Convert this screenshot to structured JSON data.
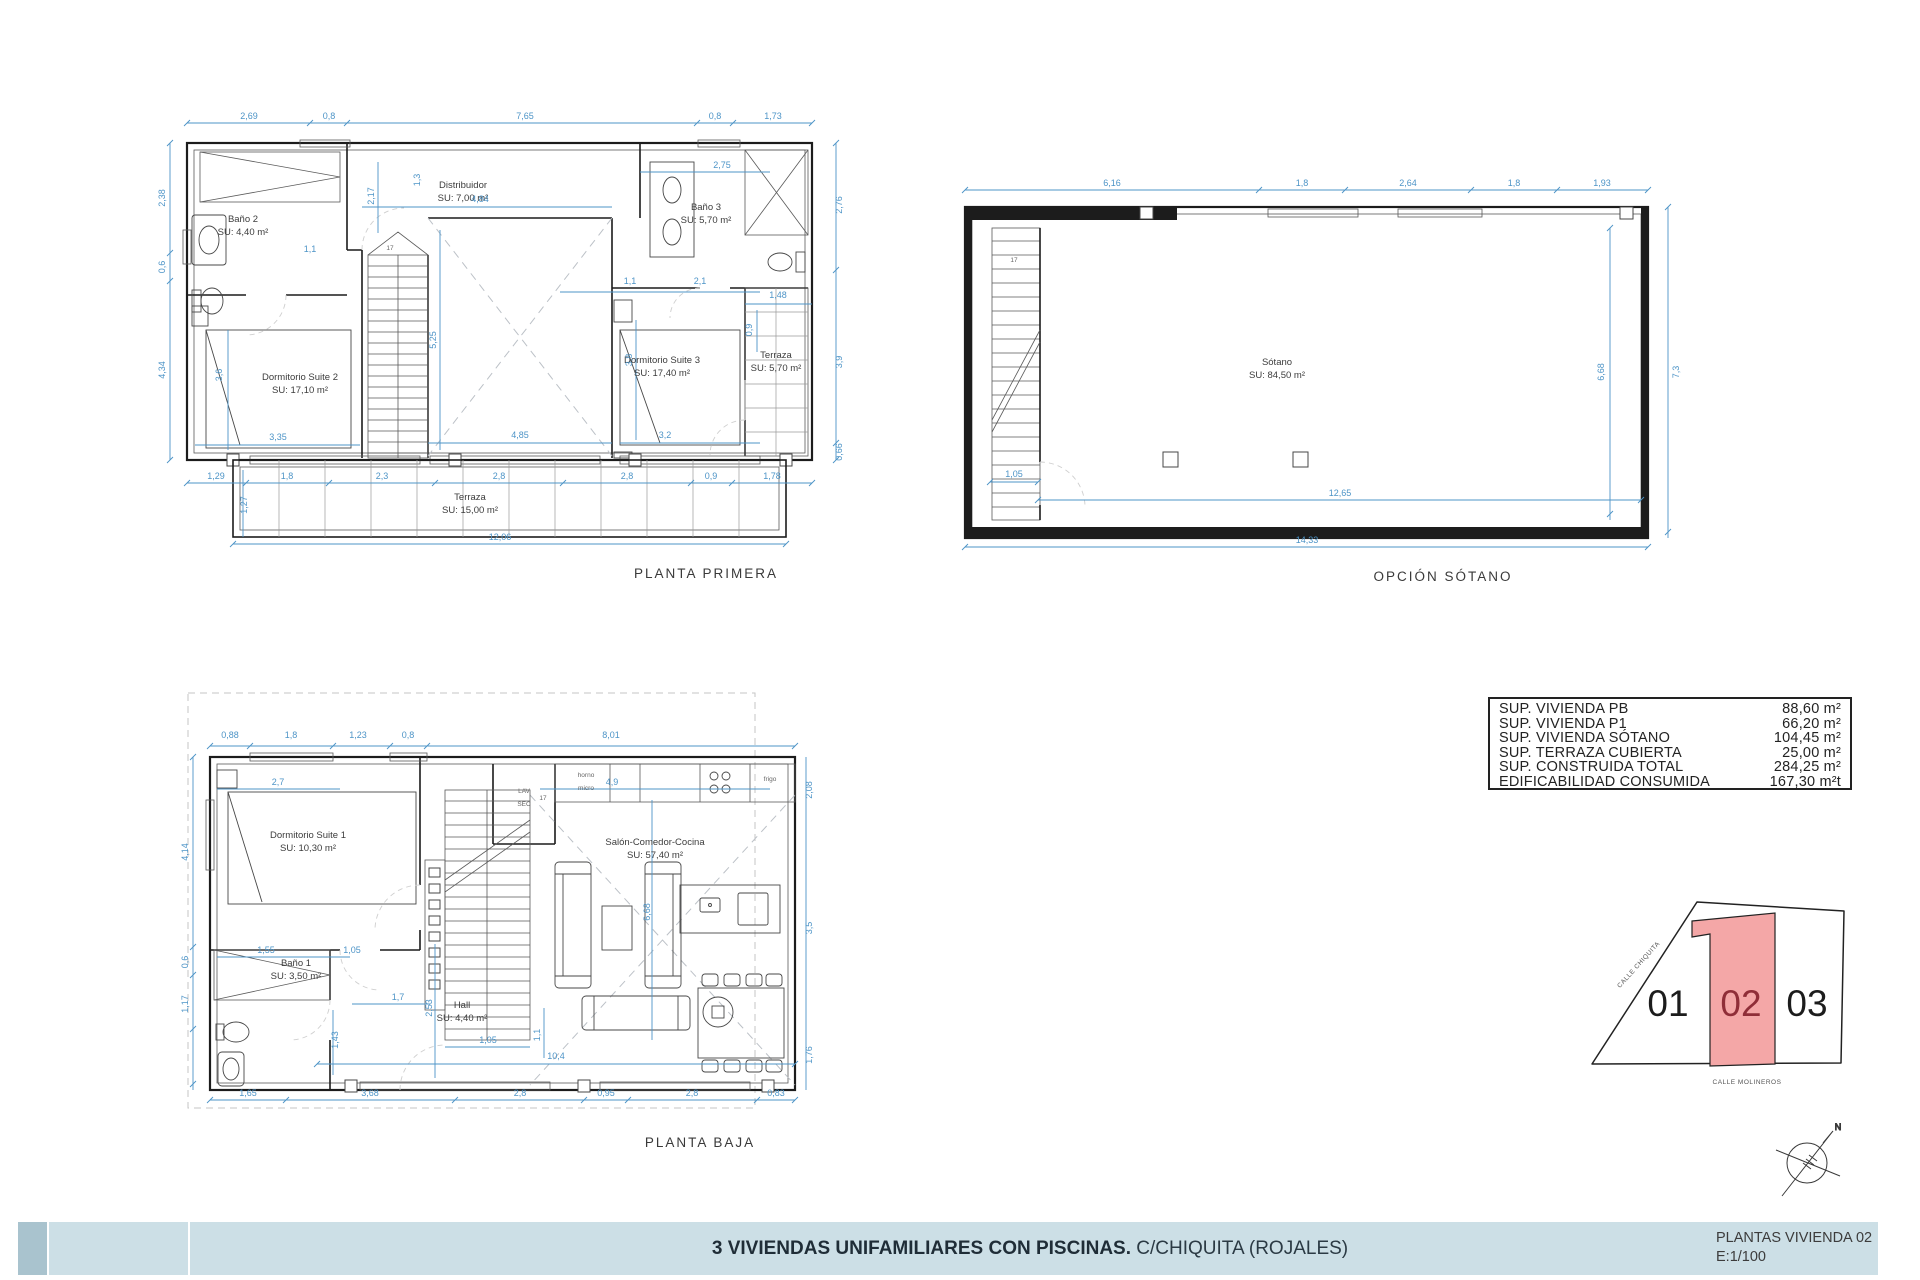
{
  "title_block": {
    "project_bold": "3 VIVIENDAS UNIFAMILIARES CON PISCINAS.",
    "project_location": " C/CHIQUITA (ROJALES)",
    "sheet_title": "PLANTAS VIVIENDA 02",
    "scale": "E:1/100"
  },
  "areas_table": {
    "rows": [
      {
        "label": "SUP. VIVIENDA PB",
        "value": "88,60 m²"
      },
      {
        "label": "SUP. VIVIENDA P1",
        "value": "66,20 m²"
      },
      {
        "label": "SUP. VIVIENDA SÓTANO",
        "value": "104,45 m²"
      },
      {
        "label": "SUP. TERRAZA CUBIERTA",
        "value": "25,00 m²"
      },
      {
        "label": "SUP. CONSTRUIDA TOTAL",
        "value": "284,25 m²"
      },
      {
        "label": "EDIFICABILIDAD CONSUMIDA",
        "value": "167,30 m²t"
      }
    ]
  },
  "site_plan": {
    "plots": [
      {
        "number": "01",
        "highlighted": false
      },
      {
        "number": "02",
        "highlighted": true
      },
      {
        "number": "03",
        "highlighted": false
      }
    ],
    "streets": [
      "CALLE CHIQUITA",
      "CALLE MOLINEROS"
    ],
    "highlight_fill": "#f4a7a7",
    "highlight_text_color": "#8f2e38"
  },
  "compass": {
    "north_label": "N"
  },
  "plans": {
    "primera": {
      "title": "PLANTA PRIMERA",
      "labels": [
        {
          "name": "banio2-label",
          "lines": [
            "Baño 2",
            "SU: 4,40 m²"
          ],
          "x": 243,
          "y": 222
        },
        {
          "name": "distribuidor-label",
          "lines": [
            "Distribuidor",
            "SU: 7,00 m²"
          ],
          "x": 463,
          "y": 188
        },
        {
          "name": "banio3-label",
          "lines": [
            "Baño 3",
            "SU: 5,70 m²"
          ],
          "x": 706,
          "y": 210
        },
        {
          "name": "suite2-label",
          "lines": [
            "Dormitorio Suite 2",
            "SU: 17,10 m²"
          ],
          "x": 300,
          "y": 380
        },
        {
          "name": "suite3-label",
          "lines": [
            "Dormitorio Suite 3",
            "SU: 17,40 m²"
          ],
          "x": 662,
          "y": 363
        },
        {
          "name": "terraza-p1-label",
          "lines": [
            "Terraza",
            "SU: 5,70 m²"
          ],
          "x": 776,
          "y": 358,
          "cls": "room"
        },
        {
          "name": "terraza-cubierta-label",
          "lines": [
            "Terraza",
            "SU: 15,00 m²"
          ],
          "x": 470,
          "y": 500
        },
        {
          "name": "stair-steps-label",
          "lines": [
            "17"
          ],
          "x": 390,
          "y": 250,
          "cls": "tiny"
        }
      ],
      "dims": [
        {
          "t": "2,69",
          "x": 249,
          "y": 119
        },
        {
          "t": "0,8",
          "x": 329,
          "y": 119
        },
        {
          "t": "7,65",
          "x": 525,
          "y": 119
        },
        {
          "t": "0,8",
          "x": 715,
          "y": 119
        },
        {
          "t": "1,73",
          "x": 773,
          "y": 119
        },
        {
          "t": "2,38",
          "x": 165,
          "y": 198,
          "rot": 1
        },
        {
          "t": "0,6",
          "x": 165,
          "y": 267,
          "rot": 1
        },
        {
          "t": "4,34",
          "x": 165,
          "y": 370,
          "rot": 1
        },
        {
          "t": "2,76",
          "x": 842,
          "y": 205,
          "rot": 1
        },
        {
          "t": "3,9",
          "x": 842,
          "y": 362,
          "rot": 1
        },
        {
          "t": "0,66",
          "x": 842,
          "y": 452,
          "rot": 1
        },
        {
          "t": "1,29",
          "x": 216,
          "y": 479
        },
        {
          "t": "1,8",
          "x": 287,
          "y": 479
        },
        {
          "t": "2,3",
          "x": 382,
          "y": 479
        },
        {
          "t": "2,8",
          "x": 499,
          "y": 479
        },
        {
          "t": "2,8",
          "x": 627,
          "y": 479
        },
        {
          "t": "0,9",
          "x": 711,
          "y": 479
        },
        {
          "t": "1,78",
          "x": 772,
          "y": 479
        },
        {
          "t": "12,06",
          "x": 500,
          "y": 540
        },
        {
          "t": "1,27",
          "x": 247,
          "y": 505,
          "rot": 1
        },
        {
          "t": "4,84",
          "x": 480,
          "y": 202
        },
        {
          "t": "1,3",
          "x": 420,
          "y": 180,
          "rot": 1
        },
        {
          "t": "2,17",
          "x": 374,
          "y": 196,
          "rot": 1
        },
        {
          "t": "1,1",
          "x": 310,
          "y": 252
        },
        {
          "t": "5,25",
          "x": 436,
          "y": 340,
          "rot": 1
        },
        {
          "t": "3,6",
          "x": 222,
          "y": 375,
          "rot": 1
        },
        {
          "t": "3,35",
          "x": 278,
          "y": 440
        },
        {
          "t": "4,85",
          "x": 520,
          "y": 438
        },
        {
          "t": "3,2",
          "x": 665,
          "y": 438
        },
        {
          "t": "1,1",
          "x": 630,
          "y": 284
        },
        {
          "t": "2,1",
          "x": 700,
          "y": 284
        },
        {
          "t": "2,75",
          "x": 722,
          "y": 168
        },
        {
          "t": "1,48",
          "x": 778,
          "y": 298
        },
        {
          "t": "3,8",
          "x": 632,
          "y": 360,
          "rot": 1
        },
        {
          "t": "0,9",
          "x": 752,
          "y": 330,
          "rot": 1
        }
      ]
    },
    "sotano": {
      "title": "OPCIÓN SÓTANO",
      "labels": [
        {
          "name": "sotano-label",
          "lines": [
            "Sótano",
            "SU: 84,50 m²"
          ],
          "x": 1277,
          "y": 365
        },
        {
          "name": "stair-steps-label",
          "lines": [
            "17"
          ],
          "x": 1014,
          "y": 262,
          "cls": "tiny"
        }
      ],
      "dims": [
        {
          "t": "6,16",
          "x": 1112,
          "y": 186
        },
        {
          "t": "1,8",
          "x": 1302,
          "y": 186
        },
        {
          "t": "2,64",
          "x": 1408,
          "y": 186
        },
        {
          "t": "1,8",
          "x": 1514,
          "y": 186
        },
        {
          "t": "1,93",
          "x": 1602,
          "y": 186
        },
        {
          "t": "7,3",
          "x": 1679,
          "y": 372,
          "rot": 1
        },
        {
          "t": "6,68",
          "x": 1604,
          "y": 372,
          "rot": 1
        },
        {
          "t": "1,05",
          "x": 1014,
          "y": 477
        },
        {
          "t": "12,65",
          "x": 1340,
          "y": 496
        },
        {
          "t": "14,33",
          "x": 1307,
          "y": 543
        }
      ]
    },
    "baja": {
      "title": "PLANTA BAJA",
      "labels": [
        {
          "name": "suite1-label",
          "lines": [
            "Dormitorio Suite 1",
            "SU: 10,30 m²"
          ],
          "x": 308,
          "y": 838
        },
        {
          "name": "banio1-label",
          "lines": [
            "Baño 1",
            "SU: 3,50 m²"
          ],
          "x": 296,
          "y": 966
        },
        {
          "name": "hall-label",
          "lines": [
            "Hall",
            "SU: 4,40 m²"
          ],
          "x": 462,
          "y": 1008
        },
        {
          "name": "salon-label",
          "lines": [
            "Salón-Comedor-Cocina",
            "SU: 57,40 m²"
          ],
          "x": 655,
          "y": 845
        },
        {
          "name": "lav-sec-label",
          "lines": [
            "LAV",
            "SEC"
          ],
          "x": 524,
          "y": 793,
          "cls": "tiny"
        },
        {
          "name": "horno-micro-label",
          "lines": [
            "horno",
            "micro"
          ],
          "x": 586,
          "y": 777,
          "cls": "tiny"
        },
        {
          "name": "frigo-label",
          "lines": [
            "frigo"
          ],
          "x": 770,
          "y": 781,
          "cls": "tiny"
        },
        {
          "name": "stair-steps-label",
          "lines": [
            "17"
          ],
          "x": 543,
          "y": 800,
          "cls": "tiny"
        }
      ],
      "dims": [
        {
          "t": "0,88",
          "x": 230,
          "y": 738
        },
        {
          "t": "1,8",
          "x": 291,
          "y": 738
        },
        {
          "t": "1,23",
          "x": 358,
          "y": 738
        },
        {
          "t": "0,8",
          "x": 408,
          "y": 738
        },
        {
          "t": "8,01",
          "x": 611,
          "y": 738
        },
        {
          "t": "4,14",
          "x": 188,
          "y": 852,
          "rot": 1
        },
        {
          "t": "0,6",
          "x": 188,
          "y": 962,
          "rot": 1
        },
        {
          "t": "1,17",
          "x": 188,
          "y": 1004,
          "rot": 1
        },
        {
          "t": "1,65",
          "x": 248,
          "y": 1096
        },
        {
          "t": "3,68",
          "x": 370,
          "y": 1096
        },
        {
          "t": "2,8",
          "x": 520,
          "y": 1096
        },
        {
          "t": "0,95",
          "x": 606,
          "y": 1096
        },
        {
          "t": "2,8",
          "x": 692,
          "y": 1096
        },
        {
          "t": "0,83",
          "x": 776,
          "y": 1096
        },
        {
          "t": "2,7",
          "x": 278,
          "y": 785
        },
        {
          "t": "4,9",
          "x": 612,
          "y": 785
        },
        {
          "t": "1,55",
          "x": 266,
          "y": 953
        },
        {
          "t": "1,05",
          "x": 352,
          "y": 953
        },
        {
          "t": "1,7",
          "x": 398,
          "y": 1000
        },
        {
          "t": "2,53",
          "x": 432,
          "y": 1008,
          "rot": 1
        },
        {
          "t": "1,05",
          "x": 488,
          "y": 1043
        },
        {
          "t": "1,1",
          "x": 540,
          "y": 1035,
          "rot": 1
        },
        {
          "t": "10,4",
          "x": 556,
          "y": 1059
        },
        {
          "t": "6,68",
          "x": 650,
          "y": 912,
          "rot": 1
        },
        {
          "t": "1,43",
          "x": 338,
          "y": 1040,
          "rot": 1
        },
        {
          "t": "2,08",
          "x": 812,
          "y": 790,
          "rot": 1
        },
        {
          "t": "3,5",
          "x": 812,
          "y": 928,
          "rot": 1
        },
        {
          "t": "1,76",
          "x": 812,
          "y": 1055,
          "rot": 1
        }
      ]
    }
  }
}
